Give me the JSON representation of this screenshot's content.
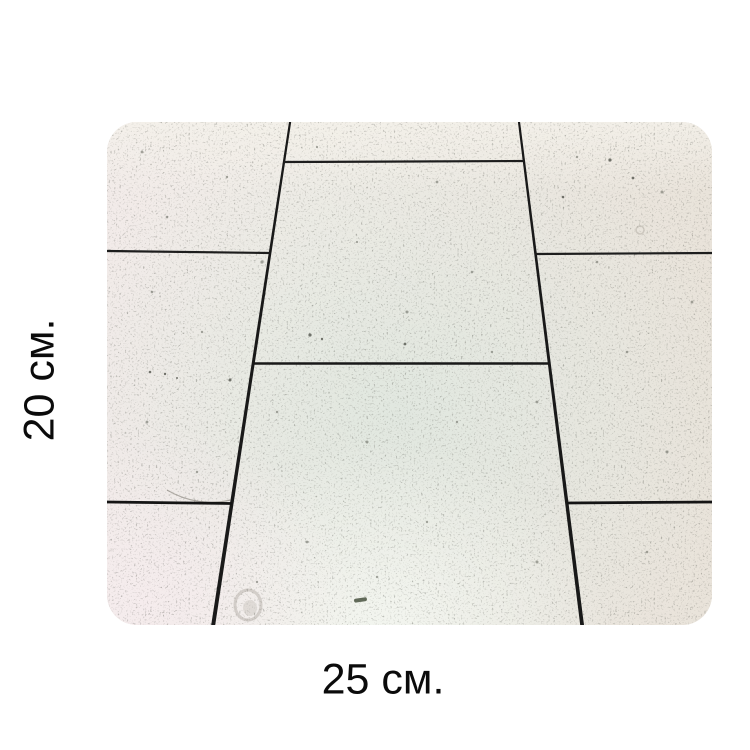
{
  "labels": {
    "height": "20 см.",
    "width": "25 см."
  },
  "figure": {
    "subject": "perspective photo of white speckled floor tiles with dark grout joints",
    "colors": {
      "page_background": "#ffffff",
      "tile_warm": "#f2ebe8",
      "tile_cool": "#e3e8e1",
      "grout": "#1c1c1c",
      "label_text": "#0b0b0b"
    }
  }
}
